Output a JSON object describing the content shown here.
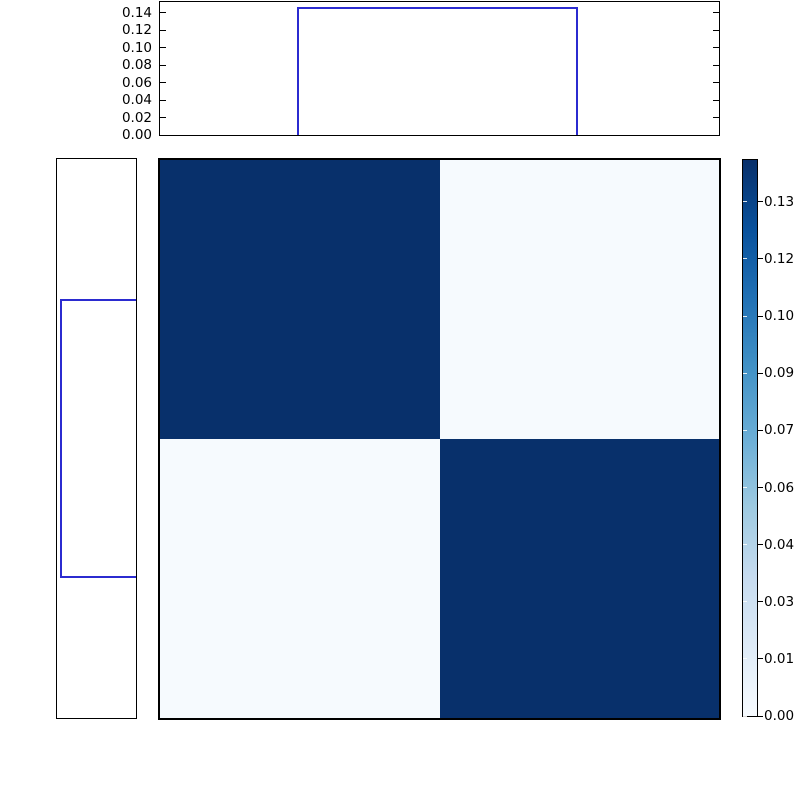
{
  "figure": {
    "background": "#ffffff",
    "line_color": "#2b2bd0",
    "axis_color": "#000000"
  },
  "chart_data": [
    {
      "id": "top_histogram",
      "type": "area",
      "orientation": "vertical",
      "title": "",
      "xlabel": "",
      "ylabel": "",
      "grid": false,
      "ylim": [
        0,
        0.1525
      ],
      "yticks": [
        {
          "value": 0.0,
          "label": "0.00"
        },
        {
          "value": 0.02,
          "label": "0.02"
        },
        {
          "value": 0.04,
          "label": "0.04"
        },
        {
          "value": 0.06,
          "label": "0.06"
        },
        {
          "value": 0.08,
          "label": "0.08"
        },
        {
          "value": 0.1,
          "label": "0.10"
        },
        {
          "value": 0.12,
          "label": "0.12"
        },
        {
          "value": 0.14,
          "label": "0.14"
        }
      ],
      "bar": {
        "start_frac": 0.245,
        "end_frac": 0.748,
        "value": 0.1473
      }
    },
    {
      "id": "left_histogram",
      "type": "area",
      "orientation": "horizontal",
      "title": "",
      "grid": false,
      "xlim": [
        0,
        0.1525
      ],
      "axis_inverted": true,
      "xticks": [],
      "bar": {
        "start_frac": 0.25,
        "end_frac": 0.749,
        "value": 0.1473
      }
    },
    {
      "id": "heatmap",
      "type": "heatmap",
      "rows": 2,
      "cols": 2,
      "values": [
        [
          0.1443,
          0.002
        ],
        [
          0.002,
          0.1443
        ]
      ],
      "vmin": 0,
      "vmax": 0.1443,
      "colormap": "Blues",
      "cell_colors": {
        "high": "#08306b",
        "low": "#f6fafe"
      }
    },
    {
      "id": "colorbar",
      "type": "colorbar",
      "vmin": 0,
      "vmax": 0.1443,
      "gradient_stops": [
        "#f7fbff",
        "#deebf7",
        "#c6dbef",
        "#9ecae1",
        "#6baed6",
        "#4292c6",
        "#2171b5",
        "#08519c",
        "#08306b"
      ],
      "ticks": [
        {
          "value": 0.0,
          "label": "0.00"
        },
        {
          "value": 0.0148,
          "label": "0.01"
        },
        {
          "value": 0.0297,
          "label": "0.03"
        },
        {
          "value": 0.0445,
          "label": "0.04"
        },
        {
          "value": 0.0593,
          "label": "0.06"
        },
        {
          "value": 0.0742,
          "label": "0.07"
        },
        {
          "value": 0.089,
          "label": "0.09"
        },
        {
          "value": 0.1038,
          "label": "0.10"
        },
        {
          "value": 0.1187,
          "label": "0.12"
        },
        {
          "value": 0.1335,
          "label": "0.13"
        }
      ]
    }
  ]
}
